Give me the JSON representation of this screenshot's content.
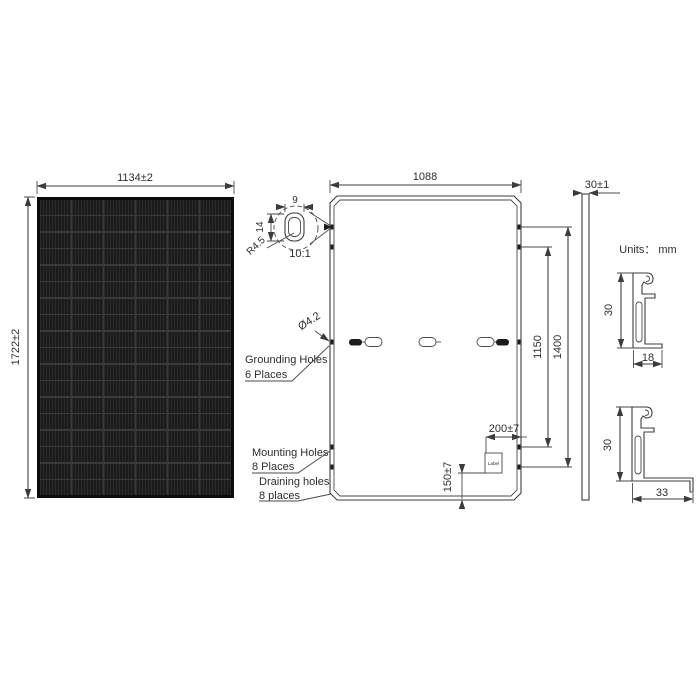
{
  "units_note": "Units： mm",
  "front_view": {
    "width_dim": "1134±2",
    "height_dim": "1722±2",
    "columns": 6,
    "rows": 18
  },
  "detail": {
    "slot_width_dim": "9",
    "slot_height_dim": "14",
    "radius_dim": "R4.5",
    "scale_note": "10:1"
  },
  "rear_view": {
    "width_dim": "1088",
    "hole_diameter_dim": "Ø4.2",
    "mounting_span_inner_dim": "1150",
    "mounting_span_outer_dim": "1400",
    "label_offset_right_dim": "200±7",
    "label_offset_bottom_dim": "150±7",
    "label_box_text": "Label",
    "grounding_note_line1": "Grounding Holes",
    "grounding_note_line2": "6 Places",
    "mounting_note_line1": "Mounting Holes",
    "mounting_note_line2": "8 Places",
    "draining_note_line1": "Draining holes",
    "draining_note_line2": "8 places"
  },
  "side_view": {
    "thickness_dim": "30±1"
  },
  "section_top": {
    "height_dim": "30",
    "width_dim": "18"
  },
  "section_bottom": {
    "height_dim": "30",
    "width_dim": "33"
  },
  "colors": {
    "line": "#3c3c3c",
    "panel_cell": "#1b1b1b",
    "panel_grid": "#3a3a3a"
  }
}
